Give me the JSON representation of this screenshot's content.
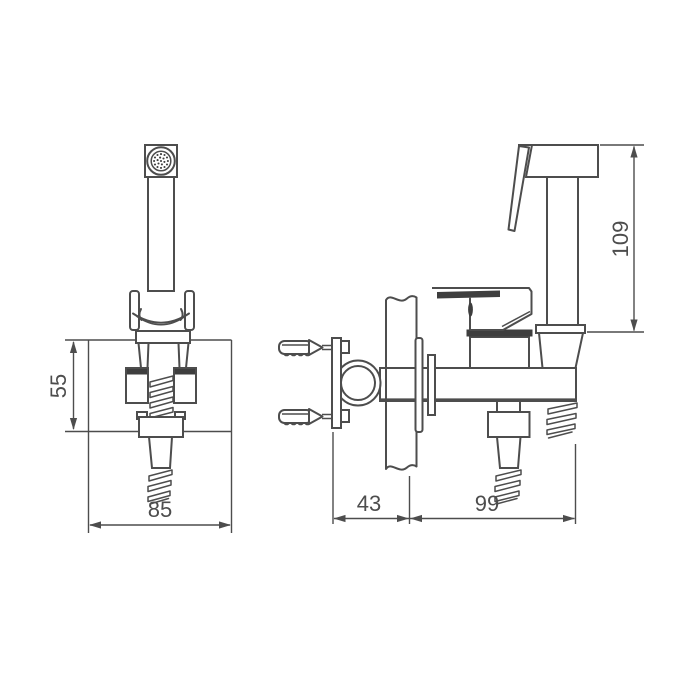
{
  "drawing": {
    "description_labels": [],
    "dimension_unit_labels_visible": false
  },
  "dimensions": {
    "bracket_height": {
      "value": "55"
    },
    "front_width": {
      "value": "85"
    },
    "wall_offset": {
      "value": "43"
    },
    "valve_length": {
      "value": "99"
    },
    "sprayer_height": {
      "value": "109"
    }
  },
  "colors": {
    "line": "#4d4d4d",
    "line_dark": "#3e3e3e",
    "background": "#ffffff",
    "text": "#4d4d4d"
  }
}
